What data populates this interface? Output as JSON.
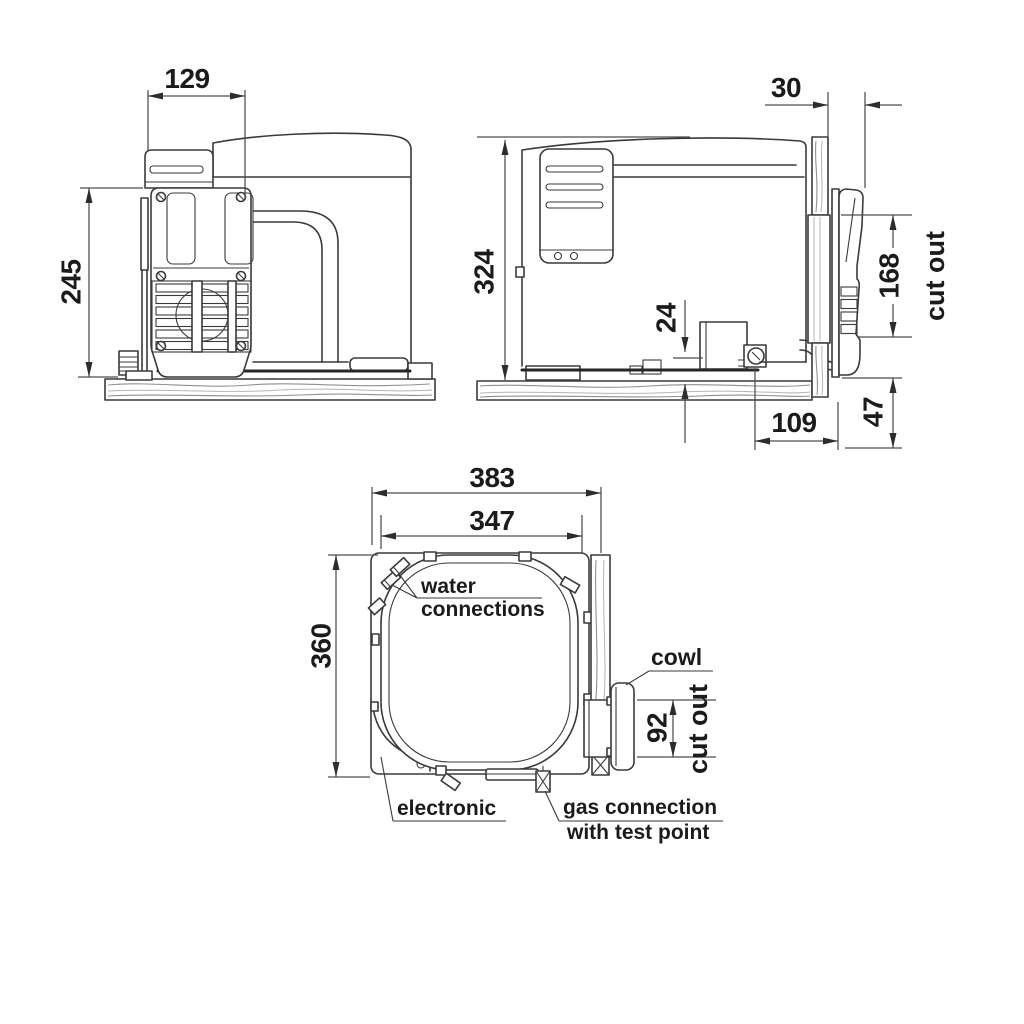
{
  "drawing_type": "technical installation drawing - gas/electric water heater, 3 views with mounting cut-out dimensions",
  "colors": {
    "background": "#ffffff",
    "line": "#3a3a3a",
    "text": "#1b1b1b",
    "grain": "#909090"
  },
  "views": {
    "side": {
      "cowl_width": "129",
      "cowl_height": "245"
    },
    "section": {
      "wall_offset": "30",
      "body_height": "324",
      "drain_offset": "24",
      "cutout_height": "168",
      "cutout_label": "cut out",
      "gas_to_wall": "109",
      "below_body": "47"
    },
    "top": {
      "overall_width": "383",
      "body_width": "347",
      "body_depth": "360",
      "cutout_width": "92",
      "cutout_label": "cut out",
      "water_label_line1": "water",
      "water_label_line2": "connections",
      "cowl_label": "cowl",
      "electronic_label": "electronic",
      "gas_label_line1": "gas connection",
      "gas_label_line2": "with test point"
    }
  }
}
